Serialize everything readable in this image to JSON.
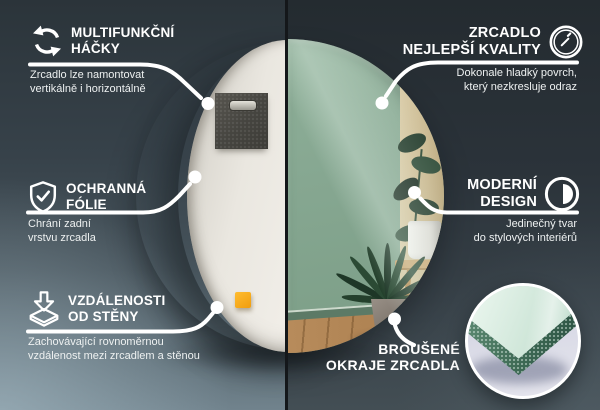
{
  "colors": {
    "accent_white": "#ffffff",
    "background_left_top": "#2b343a",
    "background_left_bottom": "#7e929b",
    "background_right_top": "#242b30",
    "background_right_bottom": "#434e54",
    "divider_dark": "#14171a",
    "mirror_glass_green": "#86a791",
    "mirror_back_panel": "#ebe8e1",
    "felt_pad_gray": "#4b4a46",
    "spacer_orange": "#f5a71d",
    "reflected_floor_wood": "#b88c5c",
    "glass_face_mint": "#cfe7da",
    "glass_edge_green": "#3a6454",
    "inset_backdrop_lavender": "#d9dae6"
  },
  "callouts": {
    "hooks": {
      "icon": "rotate-arrows-icon",
      "title1": "MULTIFUNKČNÍ",
      "title2": "HÁČKY",
      "desc1": "Zrcadlo lze namontovat",
      "desc2": "vertikálně i horizontálně"
    },
    "film": {
      "icon": "shield-check-icon",
      "title1": "OCHRANNÁ",
      "title2": "FÓLIE",
      "desc1": "Chrání zadní",
      "desc2": "vrstvu zrcadla"
    },
    "distance": {
      "icon": "distance-arrow-icon",
      "title1": "VZDÁLENOSTI",
      "title2": "OD STĚNY",
      "desc1": "Zachovávající rovnoměrnou",
      "desc2": "vzdálenost mezi zrcadlem a stěnou"
    },
    "quality": {
      "icon": "mirror-shine-icon",
      "title1": "ZRCADLO",
      "title2": "NEJLEPŠÍ KVALITY",
      "desc1": "Dokonale hladký povrch,",
      "desc2": "který nezkresluje odraz"
    },
    "design": {
      "icon": "contrast-circle-icon",
      "title1": "MODERNÍ",
      "title2": "DESIGN",
      "desc1": "Jedinečný tvar",
      "desc2": "do stylových interiérů"
    },
    "edges": {
      "icon": "edge-detail-photo",
      "title1": "BROUŠENÉ",
      "title2": "OKRAJE ZRCADLA"
    }
  }
}
